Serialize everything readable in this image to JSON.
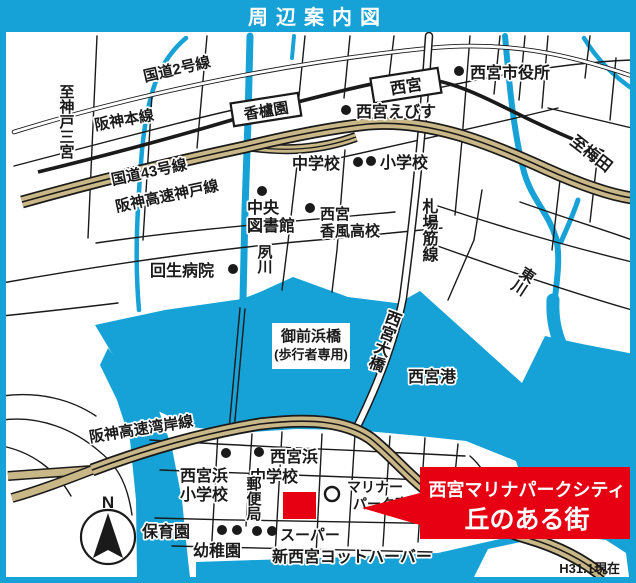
{
  "title": "周辺案内図",
  "updated": "H31.1現在",
  "banner": {
    "line1": "西宮マリナパークシティ",
    "line2": "丘のある街"
  },
  "compass": {
    "north": "N"
  },
  "stations": {
    "koroen": "香櫨園",
    "nishinomiya": "西宮"
  },
  "roads": {
    "route2": "国道2号線",
    "hanshin_main_line": "阪神本線",
    "route43": "国道43号線",
    "hanshin_exp_kobe": "阪神高速神戸線",
    "hanshin_exp_wangan": "阪神高速湾岸線",
    "fudaba_suji_line": "札場筋線",
    "nishinomiya_ohashi": "西宮大橋"
  },
  "directions": {
    "to_kobe_sannomiya": "至神戸三宮",
    "to_umeda": "至梅田"
  },
  "rivers": {
    "shukugawa": "夙川",
    "higashigawa": "東川"
  },
  "places": {
    "city_hall": "西宮市役所",
    "ebisu": "西宮えびす",
    "jhs": "中学校",
    "es": "小学校",
    "library_l1": "中央",
    "library_l2": "図書館",
    "kofu_l1": "西宮",
    "kofu_l2": "香風高校",
    "kaisei_hospital": "回生病院",
    "gozenhama_l1": "御前浜橋",
    "gozenhama_l2": "(歩行者専用)",
    "port": "西宮港",
    "hama_es_l1": "西宮浜",
    "hama_es_l2": "小学校",
    "hama_jhs_l1": "西宮浜",
    "hama_jhs_l2": "中学校",
    "post_office": "郵便局",
    "marina_park_e_l1": "マリナー",
    "marina_park_e_l2": "パーク東",
    "nursery": "保育園",
    "kindergarten": "幼稚園",
    "supermarket": "スーパー",
    "yacht_harbor": "新西宮ヨットハーバー"
  },
  "colors": {
    "frame_cyan": "#16a2d6",
    "water_cyan": "#16a2d6",
    "highway_tan": "#c9b787",
    "accent_red": "#e60012",
    "ink": "#1a1a1a"
  }
}
